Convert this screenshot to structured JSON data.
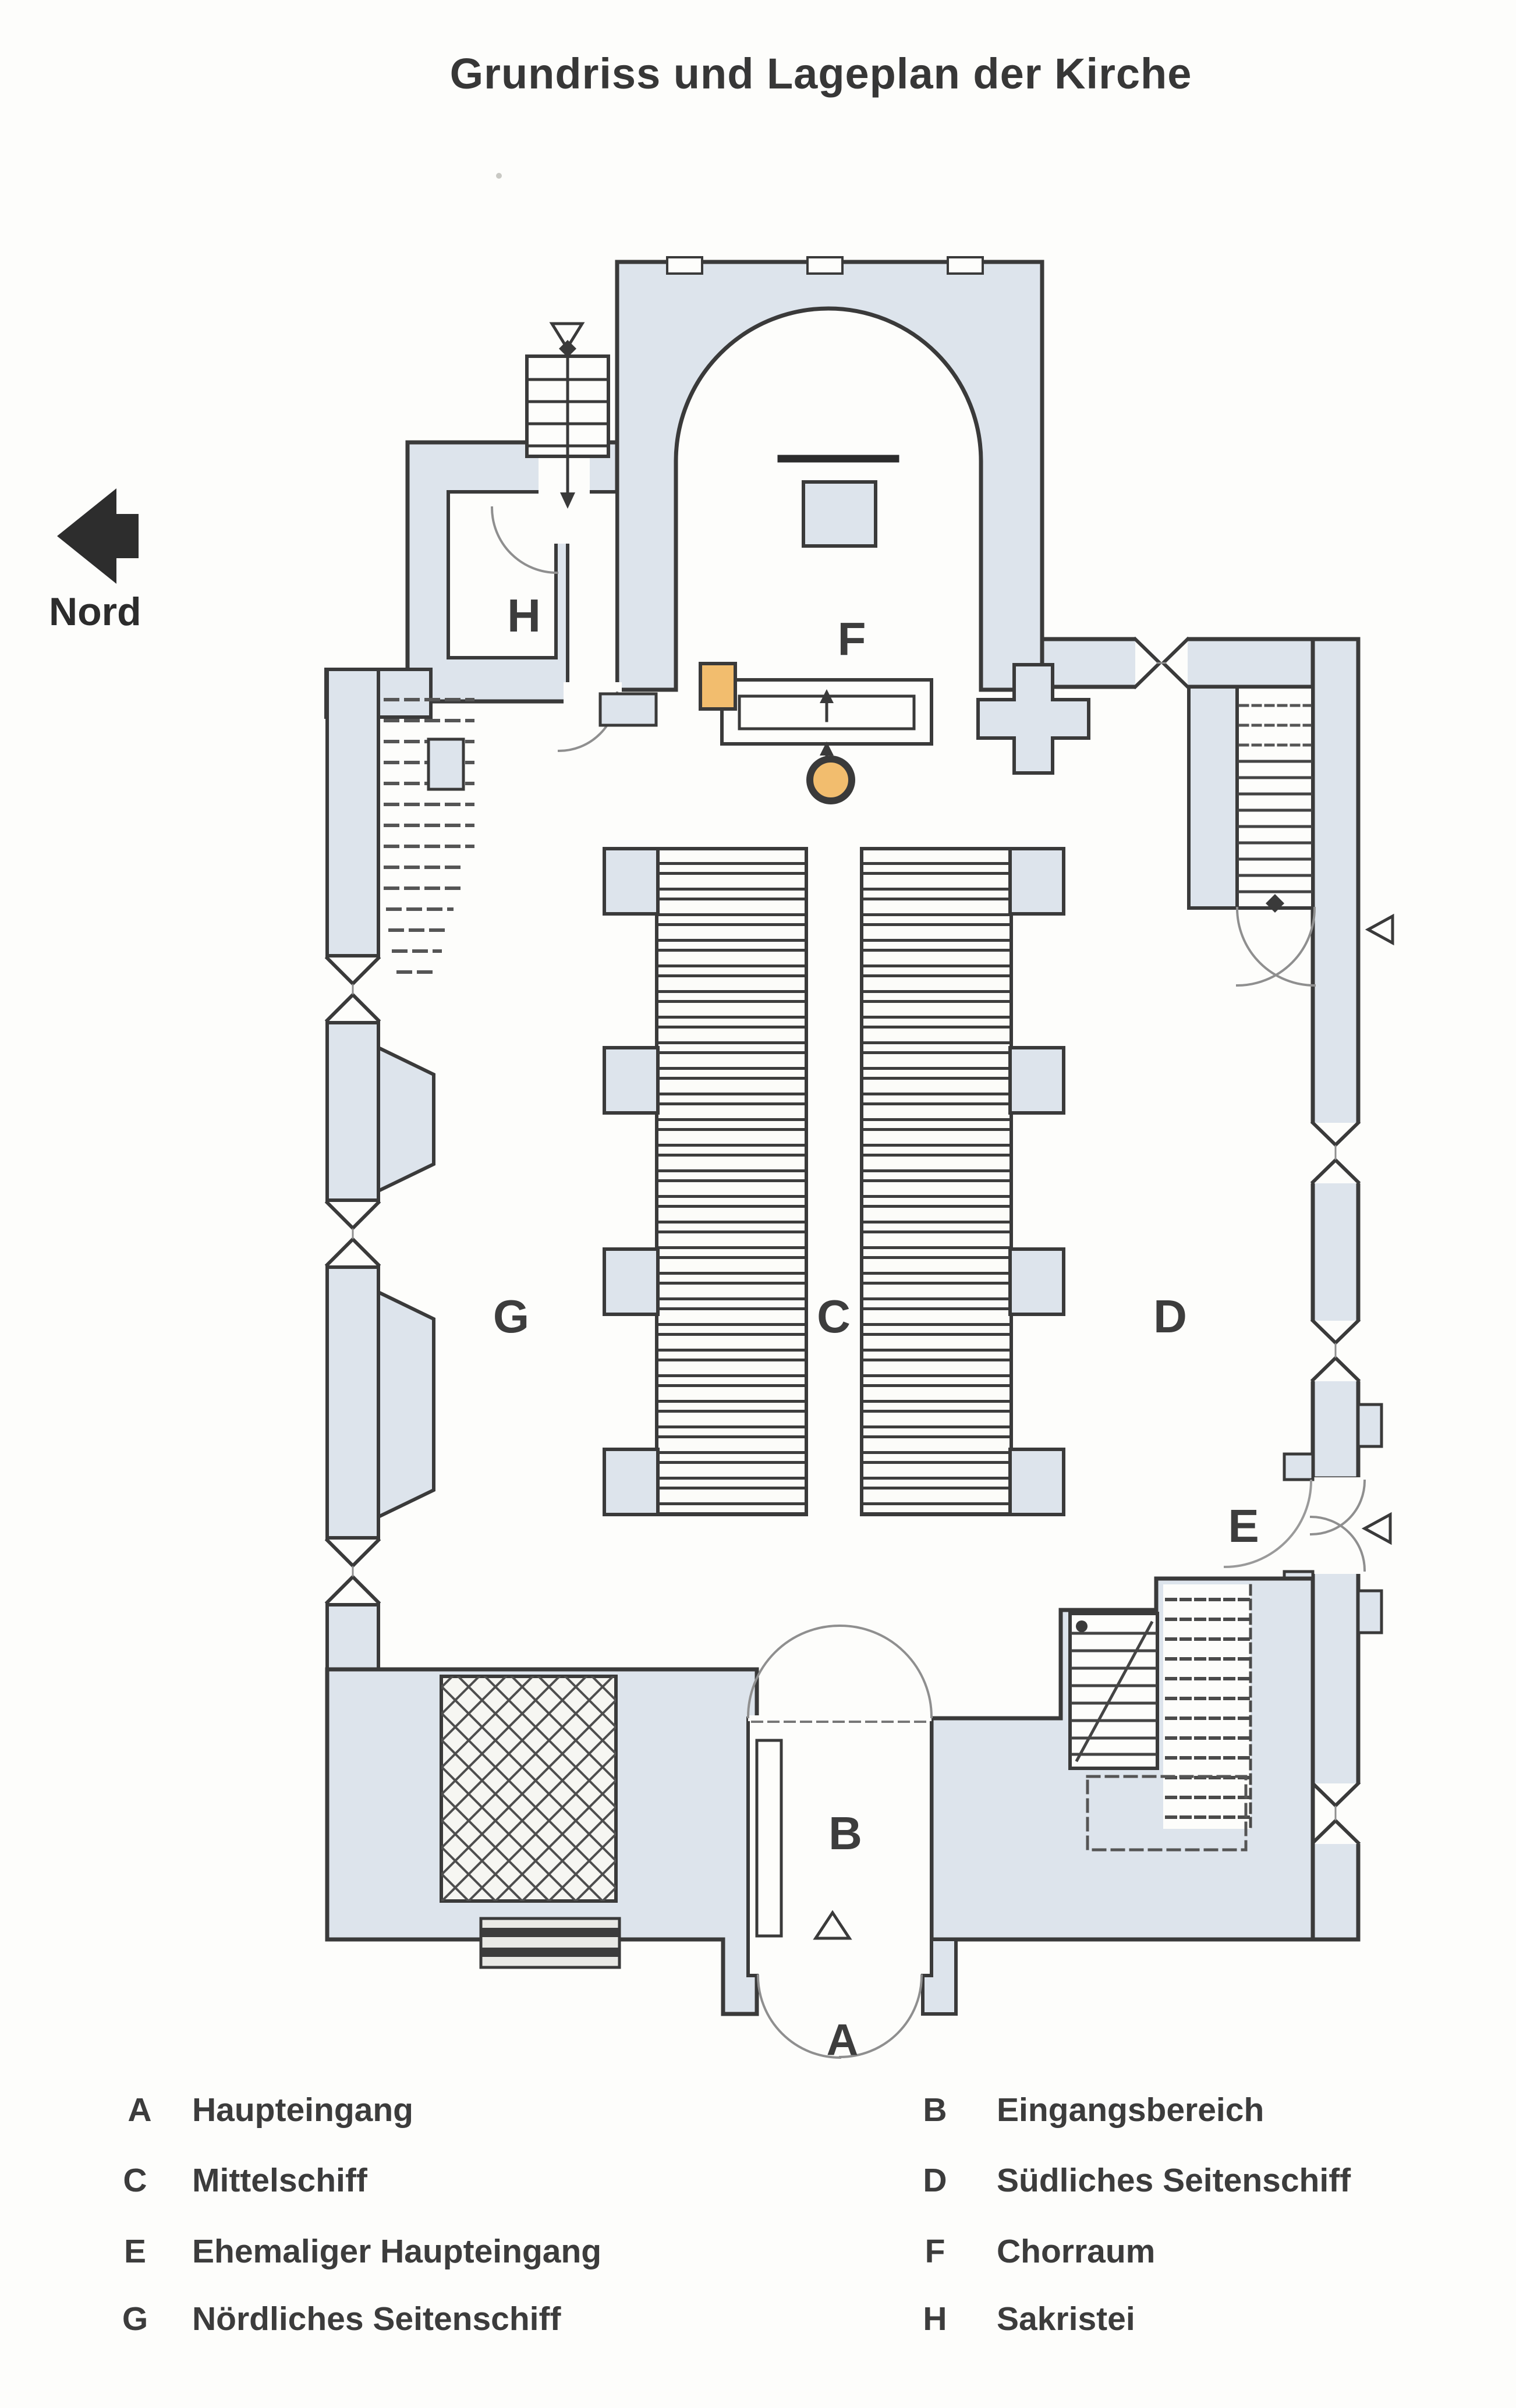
{
  "title": "Grundriss und Lageplan der Kirche",
  "compass": {
    "label": "Nord",
    "direction": "left"
  },
  "plan": {
    "rooms": {
      "A": "A",
      "B": "B",
      "C": "C",
      "D": "D",
      "E": "E",
      "F": "F",
      "G": "G",
      "H": "H"
    },
    "entrance_marker": "A"
  },
  "legend": {
    "columns": [
      {
        "items": [
          {
            "key": "A",
            "label": "Haupteingang"
          },
          {
            "key": "C",
            "label": "Mittelschiff"
          },
          {
            "key": "E",
            "label": "Ehemaliger Haupteingang"
          },
          {
            "key": "G",
            "label": "Nördliches Seitenschiff"
          }
        ]
      },
      {
        "items": [
          {
            "key": "B",
            "label": "Eingangsbereich"
          },
          {
            "key": "D",
            "label": "Südliches Seitenschiff"
          },
          {
            "key": "F",
            "label": "Chorraum"
          },
          {
            "key": "H",
            "label": "Sakristei"
          }
        ]
      }
    ]
  },
  "colors": {
    "wall_fill": "#dde4ec",
    "accent_orange": "#f2bd6e",
    "line": "#3a3a3a"
  }
}
